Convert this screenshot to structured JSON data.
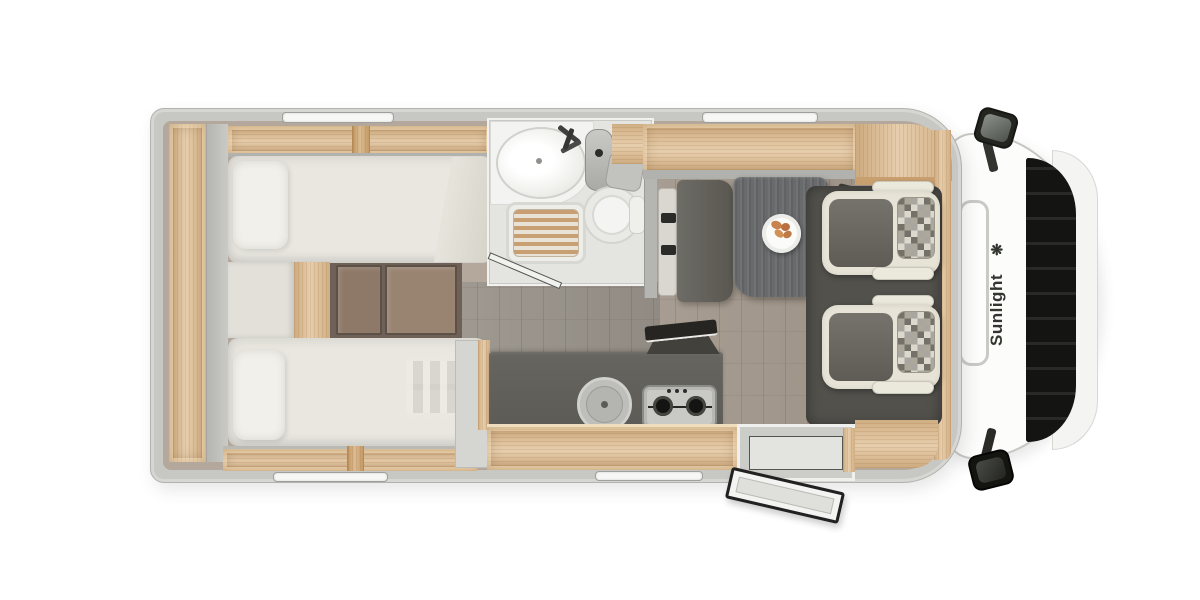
{
  "floorplan": {
    "brand": "Sunlight",
    "brand_logo_glyph": "❋",
    "view": "top-down motorhome floor plan",
    "sections": [
      {
        "id": "cab",
        "label": "driver-cab",
        "elements": [
          "windshield",
          "front-grille",
          "front-bumper",
          "roof-hatch",
          "side-mirror-top",
          "side-mirror-bottom",
          "brand-decal"
        ]
      },
      {
        "id": "dinette",
        "label": "dinette-lounge",
        "elements": [
          "bench-seat",
          "seatbelt-buckle",
          "seatbelt-buckle",
          "dining-table",
          "plate-with-croissants",
          "swivel-cab-seat",
          "swivel-cab-seat",
          "overhead-cabinet"
        ]
      },
      {
        "id": "kitchen",
        "label": "kitchenette",
        "elements": [
          "worktop",
          "round-sink-with-lid",
          "two-burner-hob",
          "open-worktop-lid",
          "cabinet-front"
        ]
      },
      {
        "id": "bathroom",
        "label": "washroom",
        "elements": [
          "washbasin",
          "faucet",
          "vanity-cabinet",
          "shower-tray-teak-grate",
          "cassette-toilet",
          "shower-door"
        ]
      },
      {
        "id": "bedroom",
        "label": "rear-twin-single-beds",
        "elements": [
          "single-bed-top",
          "single-bed-bottom",
          "pillow",
          "pillow",
          "bunk-ladder",
          "bed-steps",
          "rear-wardrobe-shelf",
          "overhead-shelf"
        ]
      },
      {
        "id": "shell",
        "label": "body-and-openings",
        "elements": [
          "window-top-left",
          "window-top-right",
          "window-bottom-left",
          "window-bottom-center",
          "entry-door-open",
          "entry-step"
        ]
      }
    ]
  },
  "theme": {
    "wall": "#c7c8c4",
    "wall_edge": "#b2b3af",
    "wood": "#e0c096",
    "wood_trim": "#c89f6f",
    "floor": "#a2978b",
    "floor_dark": "#6f6157",
    "mattress": "#e9e7e0",
    "pillow": "#f2f0ea",
    "counter": "#5c5b56",
    "table": "#696a6c",
    "seat_cream": "#e7e4d7",
    "seat_gray": "#68665f",
    "mat": "#52514c",
    "glass": "#222723",
    "cab_white": "#fcfcfb",
    "brand_text": "#33352f",
    "plate": "#fbfbf9",
    "croissant": "#c8824d"
  }
}
